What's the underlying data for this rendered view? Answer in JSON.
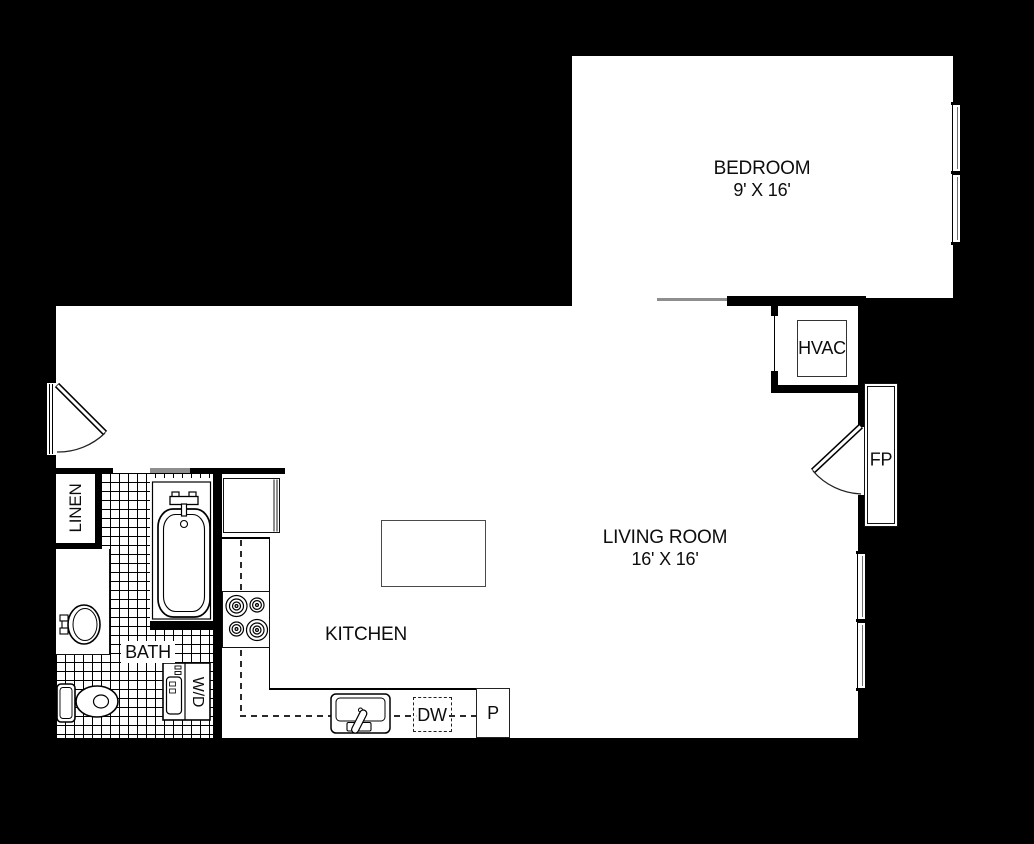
{
  "floorplan": {
    "rooms": {
      "bedroom": {
        "label": "BEDROOM",
        "dims": "9' X 16'"
      },
      "living_room": {
        "label": "LIVING ROOM",
        "dims": "16' X 16'"
      },
      "kitchen": {
        "label": "KITCHEN"
      },
      "bath": {
        "label": "BATH"
      }
    },
    "fixtures": {
      "hvac": {
        "label": "HVAC"
      },
      "fireplace": {
        "label": "FP"
      },
      "linen_closet": {
        "label": "LINEN"
      },
      "washer_dryer": {
        "label": "W/D"
      },
      "dishwasher": {
        "label": "DW"
      },
      "pantry": {
        "label": "P"
      }
    },
    "colors": {
      "background": "#000000",
      "floor": "#ffffff",
      "wall": "#000000",
      "opening_header": "#8e8e8e",
      "line": "#111111"
    }
  }
}
